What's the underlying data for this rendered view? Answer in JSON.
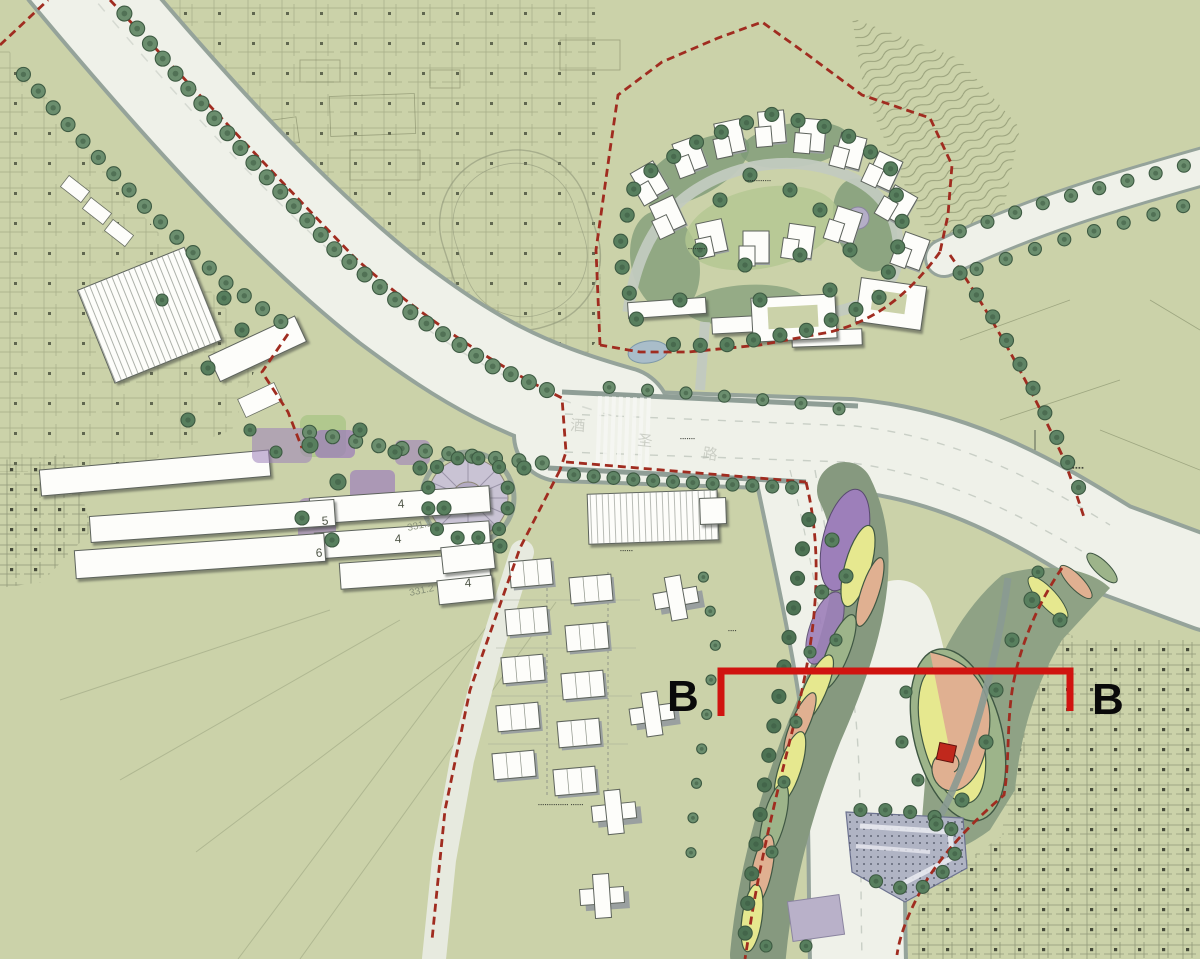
{
  "section_cut": {
    "left_label": "B",
    "right_label": "B"
  },
  "labels": {
    "bldg_4a": "4",
    "bldg_5": "5",
    "bldg_4b": "4",
    "bldg_6": "6",
    "bldg_4c": "4",
    "elev_1": "331.1",
    "elev_2": "331.2",
    "road_char_1": "酒",
    "road_char_2": "圣",
    "road_char_3": "路"
  },
  "annotations": {
    "developer_note": "▪▪▪▪▪▪▪▪▪▪▪▪▪▪ ▪▪▪▪▪▪",
    "cluster_note": "▪▪▪▪▪▪▪▪▪▪▪▪",
    "frontage_note": "▪▪▪▪▪▪▪▪",
    "road_note": "▪▪▪▪▪▪▪",
    "village_name": "▪▪▪▪",
    "park_note": "▪▪▪▪",
    "sales_note": "▪▪▪▪▪▪"
  },
  "colors": {
    "site_green": "#cbd2a9",
    "road": "#eff1e9",
    "boundary_red": "#a02c20",
    "section_red": "#d01410",
    "tree_green": "#6b8e6e",
    "purple": "#9d7fba",
    "yellow": "#e6e88f",
    "salmon": "#e0b091",
    "lavender": "#b9b1c9",
    "pond_blue": "#a9bdc9"
  }
}
